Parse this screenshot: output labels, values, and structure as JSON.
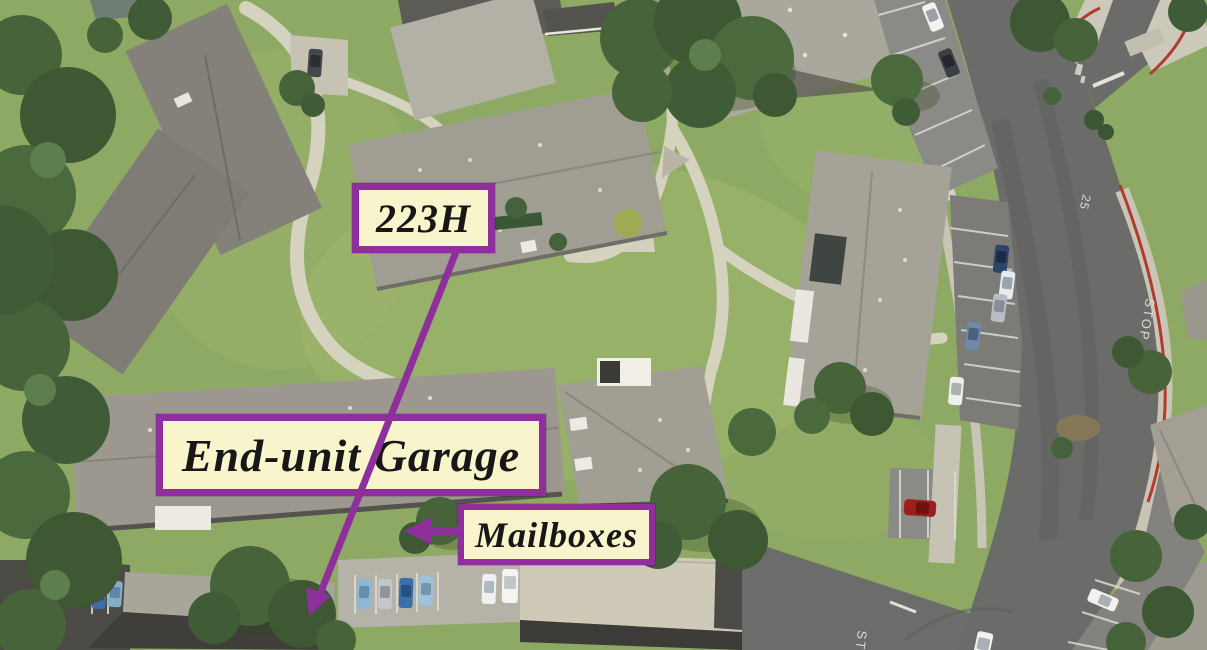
{
  "annotations": {
    "unit": {
      "label": "223H"
    },
    "garage": {
      "label": "End-unit Garage"
    },
    "mailboxes": {
      "label": "Mailboxes"
    }
  },
  "road_markings": {
    "stop_main_road": "STOP",
    "stop_drive": "STOP",
    "speed_limit": "25"
  },
  "colors": {
    "label_background": "#f8f4cc",
    "label_border": "#8e2f9c",
    "label_text": "#171717",
    "arrow": "#8e2f9c",
    "grass": "#8da963",
    "tree_green": "#46633a",
    "roof_gray": "#9e9a90",
    "road_asphalt": "#6b6b69",
    "concrete_path": "#d6d2c0",
    "red_curb": "#b23b30"
  }
}
